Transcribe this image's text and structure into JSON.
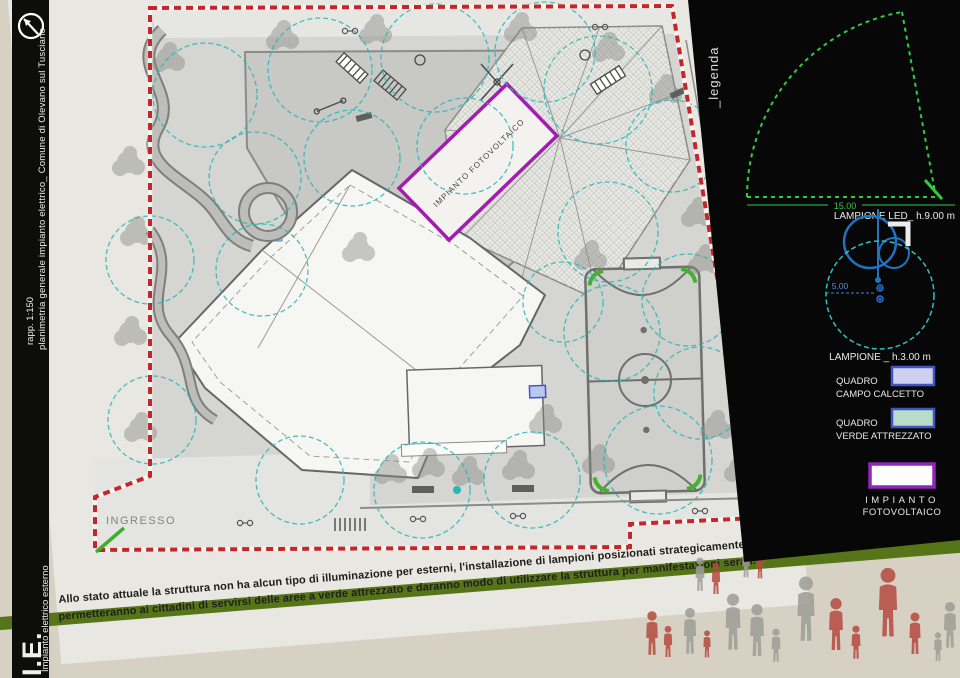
{
  "sidebar": {
    "title": "planimetria generale impianto elettrico_ Comune di Olevano sul Tusciano",
    "scale": "rapp. 1:150",
    "section_code": "I.E.",
    "section_label": "Impianto elettrico esterno"
  },
  "plan": {
    "entrance_label": "INGRESSO",
    "photovoltaic_label": "IMPIANTO FOTOVOLTAICO"
  },
  "legend": {
    "title": "_legenda",
    "lamp_tall": {
      "label": "LAMPIONE LED_ h.9.00 m",
      "radius": "15.00"
    },
    "lamp_short": {
      "label": "LAMPIONE _ h.3.00 m",
      "radius": "5.00"
    },
    "quadro_calcetto": {
      "line1": "QUADRO",
      "line2": "CAMPO CALCETTO"
    },
    "quadro_verde": {
      "line1": "QUADRO",
      "line2": "VERDE ATTREZZATO"
    },
    "impianto_fv": {
      "line1": "IMPIANTO",
      "line2": "FOTOVOLTAICO"
    }
  },
  "caption": {
    "line1": "Allo stato attuale la struttura non ha alcun tipo di illuminazione per esterni, l'installazione di lampioni posizionati strategicamente",
    "line2": "permetteranno ai cittadini di servirsi delle aree a verde attrezzato e daranno modo di utilizzare la struttura per manifestazioni serali."
  },
  "colors": {
    "boundary_red": "#c1272d",
    "lamp_range_cyan": "#2ab6b9",
    "legend_green": "#2ecc40",
    "photovoltaic_purple": "#a21caf",
    "band_olive": "#567518",
    "swatch_calcetto": "#cdd1ef",
    "swatch_verde": "#b9dcc9",
    "people_red": "#b5493f",
    "people_gray": "#9d9d97"
  }
}
